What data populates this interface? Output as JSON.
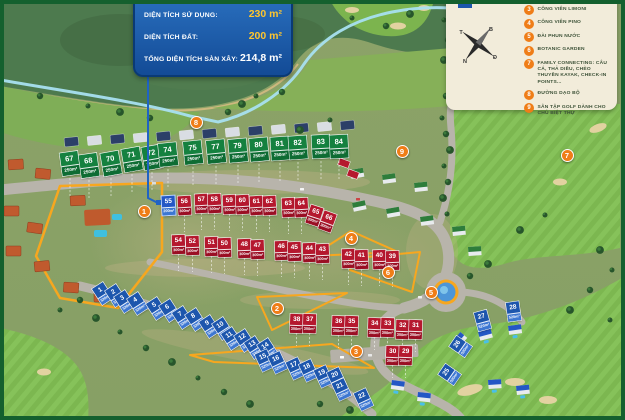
{
  "info_panel": {
    "rows": [
      {
        "label": "DIỆN TÍCH SỬ DỤNG:",
        "value": "230 m²",
        "highlight": true
      },
      {
        "label": "DIỆN TÍCH ĐẤT:",
        "value": "200 m²",
        "highlight": true
      },
      {
        "label": "TỔNG DIỆN TÍCH SÀN XÂY:",
        "value": "214,8 m²",
        "highlight": false
      }
    ]
  },
  "legend": {
    "swatch_label": "SKY VILLAS",
    "compass": {
      "north": "B",
      "east": "Đ",
      "south": "N",
      "west": "T"
    },
    "items": [
      {
        "num": "3",
        "label": "CÔNG VIÊN LIMONI"
      },
      {
        "num": "4",
        "label": "CÔNG VIÊN PINO"
      },
      {
        "num": "5",
        "label": "ĐÀI PHUN NƯỚC"
      },
      {
        "num": "6",
        "label": "BOTANIC GARDEN"
      },
      {
        "num": "7",
        "label": "FAMILY CONNECTING: CÂU CÁ, THẢ DIỀU, CHÈO THUYỀN KAYAK, CHECK-IN POINTS..."
      },
      {
        "num": "8",
        "label": "ĐƯỜNG DẠO BỘ"
      },
      {
        "num": "9",
        "label": "SÂN TẬP GOLF DÀNH CHO CHỦ BIỆT THỰ"
      }
    ]
  },
  "map": {
    "selected_lot": {
      "n": "55",
      "x": 162,
      "y": 196,
      "r": -3,
      "area": "200m²"
    },
    "areas": {
      "g": "250m²",
      "r": "300m²",
      "b": "520m²"
    },
    "markers": [
      {
        "num": "1",
        "x": 144,
        "y": 211
      },
      {
        "num": "2",
        "x": 277,
        "y": 308
      },
      {
        "num": "3",
        "x": 356,
        "y": 351
      },
      {
        "num": "4",
        "x": 351,
        "y": 238
      },
      {
        "num": "5",
        "x": 431,
        "y": 292
      },
      {
        "num": "6",
        "x": 388,
        "y": 272
      },
      {
        "num": "7",
        "x": 567,
        "y": 155
      },
      {
        "num": "8",
        "x": 196,
        "y": 122
      },
      {
        "num": "9",
        "x": 402,
        "y": 151
      }
    ],
    "lots": [
      {
        "n": "67",
        "c": "g",
        "x": 61,
        "y": 152,
        "r": -8
      },
      {
        "n": "68",
        "c": "g",
        "x": 80,
        "y": 154,
        "r": -8
      },
      {
        "n": "70",
        "c": "g",
        "x": 102,
        "y": 152,
        "r": -10
      },
      {
        "n": "71",
        "c": "g",
        "x": 123,
        "y": 148,
        "r": -10
      },
      {
        "n": "72",
        "c": "g",
        "x": 143,
        "y": 146,
        "r": -10
      },
      {
        "n": "74",
        "c": "g",
        "x": 159,
        "y": 143,
        "r": -6
      },
      {
        "n": "75",
        "c": "g",
        "x": 184,
        "y": 141,
        "r": -6
      },
      {
        "n": "77",
        "c": "g",
        "x": 207,
        "y": 140,
        "r": -6
      },
      {
        "n": "79",
        "c": "g",
        "x": 229,
        "y": 139,
        "r": -5
      },
      {
        "n": "80",
        "c": "g",
        "x": 250,
        "y": 138,
        "r": -5
      },
      {
        "n": "81",
        "c": "g",
        "x": 271,
        "y": 137,
        "r": -4
      },
      {
        "n": "82",
        "c": "g",
        "x": 289,
        "y": 136,
        "r": -4
      },
      {
        "n": "83",
        "c": "g",
        "x": 312,
        "y": 135,
        "r": -3
      },
      {
        "n": "84",
        "c": "g",
        "x": 330,
        "y": 135,
        "r": -3
      },
      {
        "n": "56",
        "c": "r",
        "x": 178,
        "y": 196,
        "r": -3
      },
      {
        "n": "57",
        "c": "r",
        "x": 195,
        "y": 194,
        "r": -3
      },
      {
        "n": "58",
        "c": "r",
        "x": 208,
        "y": 194,
        "r": -3
      },
      {
        "n": "59",
        "c": "r",
        "x": 223,
        "y": 195,
        "r": -3
      },
      {
        "n": "60",
        "c": "r",
        "x": 236,
        "y": 195,
        "r": -3
      },
      {
        "n": "61",
        "c": "r",
        "x": 250,
        "y": 196,
        "r": -3
      },
      {
        "n": "62",
        "c": "r",
        "x": 263,
        "y": 196,
        "r": -3
      },
      {
        "n": "63",
        "c": "r",
        "x": 282,
        "y": 198,
        "r": -3
      },
      {
        "n": "64",
        "c": "r",
        "x": 295,
        "y": 198,
        "r": -3
      },
      {
        "n": "65",
        "c": "r",
        "x": 308,
        "y": 206,
        "r": 18
      },
      {
        "n": "66",
        "c": "r",
        "x": 321,
        "y": 212,
        "r": 20
      },
      {
        "n": "54",
        "c": "r",
        "x": 172,
        "y": 235,
        "r": -2
      },
      {
        "n": "52",
        "c": "r",
        "x": 186,
        "y": 236,
        "r": -2
      },
      {
        "n": "51",
        "c": "r",
        "x": 205,
        "y": 237,
        "r": -2
      },
      {
        "n": "50",
        "c": "r",
        "x": 218,
        "y": 238,
        "r": -2
      },
      {
        "n": "48",
        "c": "r",
        "x": 238,
        "y": 239,
        "r": -2
      },
      {
        "n": "47",
        "c": "r",
        "x": 251,
        "y": 240,
        "r": -2
      },
      {
        "n": "46",
        "c": "r",
        "x": 275,
        "y": 241,
        "r": -2
      },
      {
        "n": "45",
        "c": "r",
        "x": 288,
        "y": 242,
        "r": -2
      },
      {
        "n": "44",
        "c": "r",
        "x": 303,
        "y": 243,
        "r": -2
      },
      {
        "n": "43",
        "c": "r",
        "x": 316,
        "y": 244,
        "r": -2
      },
      {
        "n": "42",
        "c": "r",
        "x": 342,
        "y": 249,
        "r": -2
      },
      {
        "n": "41",
        "c": "r",
        "x": 355,
        "y": 250,
        "r": -2
      },
      {
        "n": "40",
        "c": "r",
        "x": 373,
        "y": 250,
        "r": -2
      },
      {
        "n": "39",
        "c": "r",
        "x": 386,
        "y": 251,
        "r": -2
      },
      {
        "n": "38",
        "c": "r",
        "x": 290,
        "y": 314,
        "r": 2
      },
      {
        "n": "37",
        "c": "r",
        "x": 303,
        "y": 314,
        "r": 2
      },
      {
        "n": "36",
        "c": "r",
        "x": 332,
        "y": 316,
        "r": 2
      },
      {
        "n": "35",
        "c": "r",
        "x": 345,
        "y": 316,
        "r": 2
      },
      {
        "n": "34",
        "c": "r",
        "x": 368,
        "y": 318,
        "r": 2
      },
      {
        "n": "33",
        "c": "r",
        "x": 381,
        "y": 318,
        "r": 2
      },
      {
        "n": "32",
        "c": "r",
        "x": 396,
        "y": 320,
        "r": 2
      },
      {
        "n": "31",
        "c": "r",
        "x": 409,
        "y": 320,
        "r": 2
      },
      {
        "n": "30",
        "c": "r",
        "x": 386,
        "y": 346,
        "r": 2
      },
      {
        "n": "29",
        "c": "r",
        "x": 399,
        "y": 346,
        "r": 2
      },
      {
        "n": "1",
        "c": "b",
        "x": 96,
        "y": 284,
        "r": -33
      },
      {
        "n": "2",
        "c": "b",
        "x": 109,
        "y": 286,
        "r": -33
      },
      {
        "n": "3",
        "c": "b",
        "x": 118,
        "y": 292,
        "r": -33
      },
      {
        "n": "4",
        "c": "b",
        "x": 131,
        "y": 294,
        "r": -33
      },
      {
        "n": "5",
        "c": "b",
        "x": 150,
        "y": 299,
        "r": -33
      },
      {
        "n": "6",
        "c": "b",
        "x": 163,
        "y": 301,
        "r": -33
      },
      {
        "n": "7",
        "c": "b",
        "x": 176,
        "y": 308,
        "r": -33
      },
      {
        "n": "8",
        "c": "b",
        "x": 189,
        "y": 310,
        "r": -33
      },
      {
        "n": "9",
        "c": "b",
        "x": 203,
        "y": 317,
        "r": -33
      },
      {
        "n": "10",
        "c": "b",
        "x": 216,
        "y": 319,
        "r": -33
      },
      {
        "n": "11",
        "c": "b",
        "x": 225,
        "y": 329,
        "r": -33
      },
      {
        "n": "12",
        "c": "b",
        "x": 238,
        "y": 331,
        "r": -33
      },
      {
        "n": "13",
        "c": "b",
        "x": 248,
        "y": 338,
        "r": -33
      },
      {
        "n": "14",
        "c": "b",
        "x": 261,
        "y": 340,
        "r": -33
      },
      {
        "n": "15",
        "c": "b",
        "x": 258,
        "y": 351,
        "r": -25
      },
      {
        "n": "16",
        "c": "b",
        "x": 271,
        "y": 353,
        "r": -25
      },
      {
        "n": "17",
        "c": "b",
        "x": 289,
        "y": 359,
        "r": -25
      },
      {
        "n": "18",
        "c": "b",
        "x": 302,
        "y": 361,
        "r": -25
      },
      {
        "n": "19",
        "c": "b",
        "x": 317,
        "y": 367,
        "r": -25
      },
      {
        "n": "20",
        "c": "b",
        "x": 330,
        "y": 369,
        "r": -25
      },
      {
        "n": "21",
        "c": "b",
        "x": 335,
        "y": 380,
        "r": -25
      },
      {
        "n": "22",
        "c": "b",
        "x": 357,
        "y": 390,
        "r": -25
      },
      {
        "n": "25",
        "c": "b",
        "x": 443,
        "y": 365,
        "r": -55
      },
      {
        "n": "26",
        "c": "b",
        "x": 454,
        "y": 337,
        "r": -55
      },
      {
        "n": "27",
        "c": "b",
        "x": 476,
        "y": 311,
        "r": -15
      },
      {
        "n": "28",
        "c": "b",
        "x": 507,
        "y": 302,
        "r": -8
      }
    ]
  },
  "colors": {
    "marker_orange": "#ef7d17",
    "boundary_orange": "#f7a71f",
    "lot_green": "#15813f",
    "lot_red": "#b5182e",
    "lot_blue": "#1d56ad",
    "panel_blue": "#134b96",
    "value_yellow": "#ffc62e",
    "legend_bg": "#f2ecda",
    "walking_path": "#a8e0f0"
  }
}
